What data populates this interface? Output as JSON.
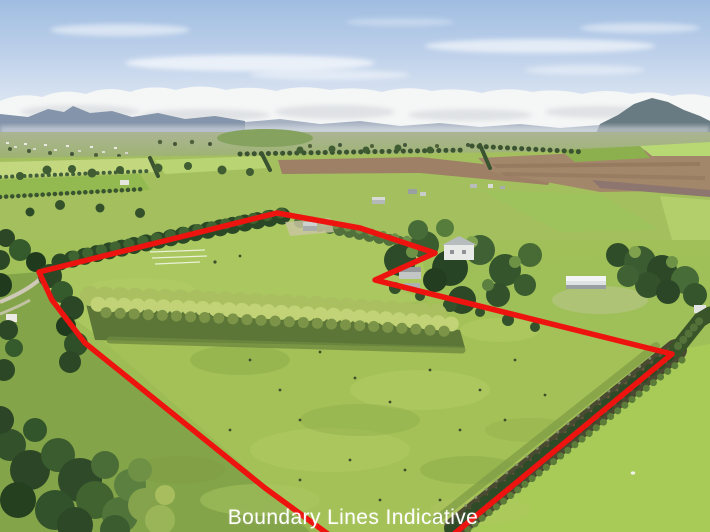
{
  "photo": {
    "kind": "aerial-property-listing-photo",
    "caption": {
      "text": "Boundary Lines Indicative",
      "color": "#ffffff",
      "font_size": 21
    },
    "boundary": {
      "color": "#ed1410",
      "stroke_width": 5.5,
      "points": [
        [
          437,
          548
        ],
        [
          672,
          354
        ],
        [
          375,
          280
        ],
        [
          435,
          253
        ],
        [
          360,
          228
        ],
        [
          277,
          213
        ],
        [
          39,
          272
        ],
        [
          52,
          300
        ],
        [
          85,
          343
        ],
        [
          265,
          488
        ],
        [
          347,
          548
        ]
      ]
    },
    "palette": {
      "sky_top": "#9fbde1",
      "cloud_white": "#f5f6f6",
      "mountain_blue": "#8494aa",
      "right_hill": "#687a82",
      "distant_field": "#a4c05e",
      "paddock_green": "#9dbc53",
      "plowed_brown": "#9d8065",
      "hedge_brown": "#77603f",
      "shelterbelt_dark": "#2c4a27",
      "poplar_yellow_green": "#b7ca6c"
    }
  }
}
